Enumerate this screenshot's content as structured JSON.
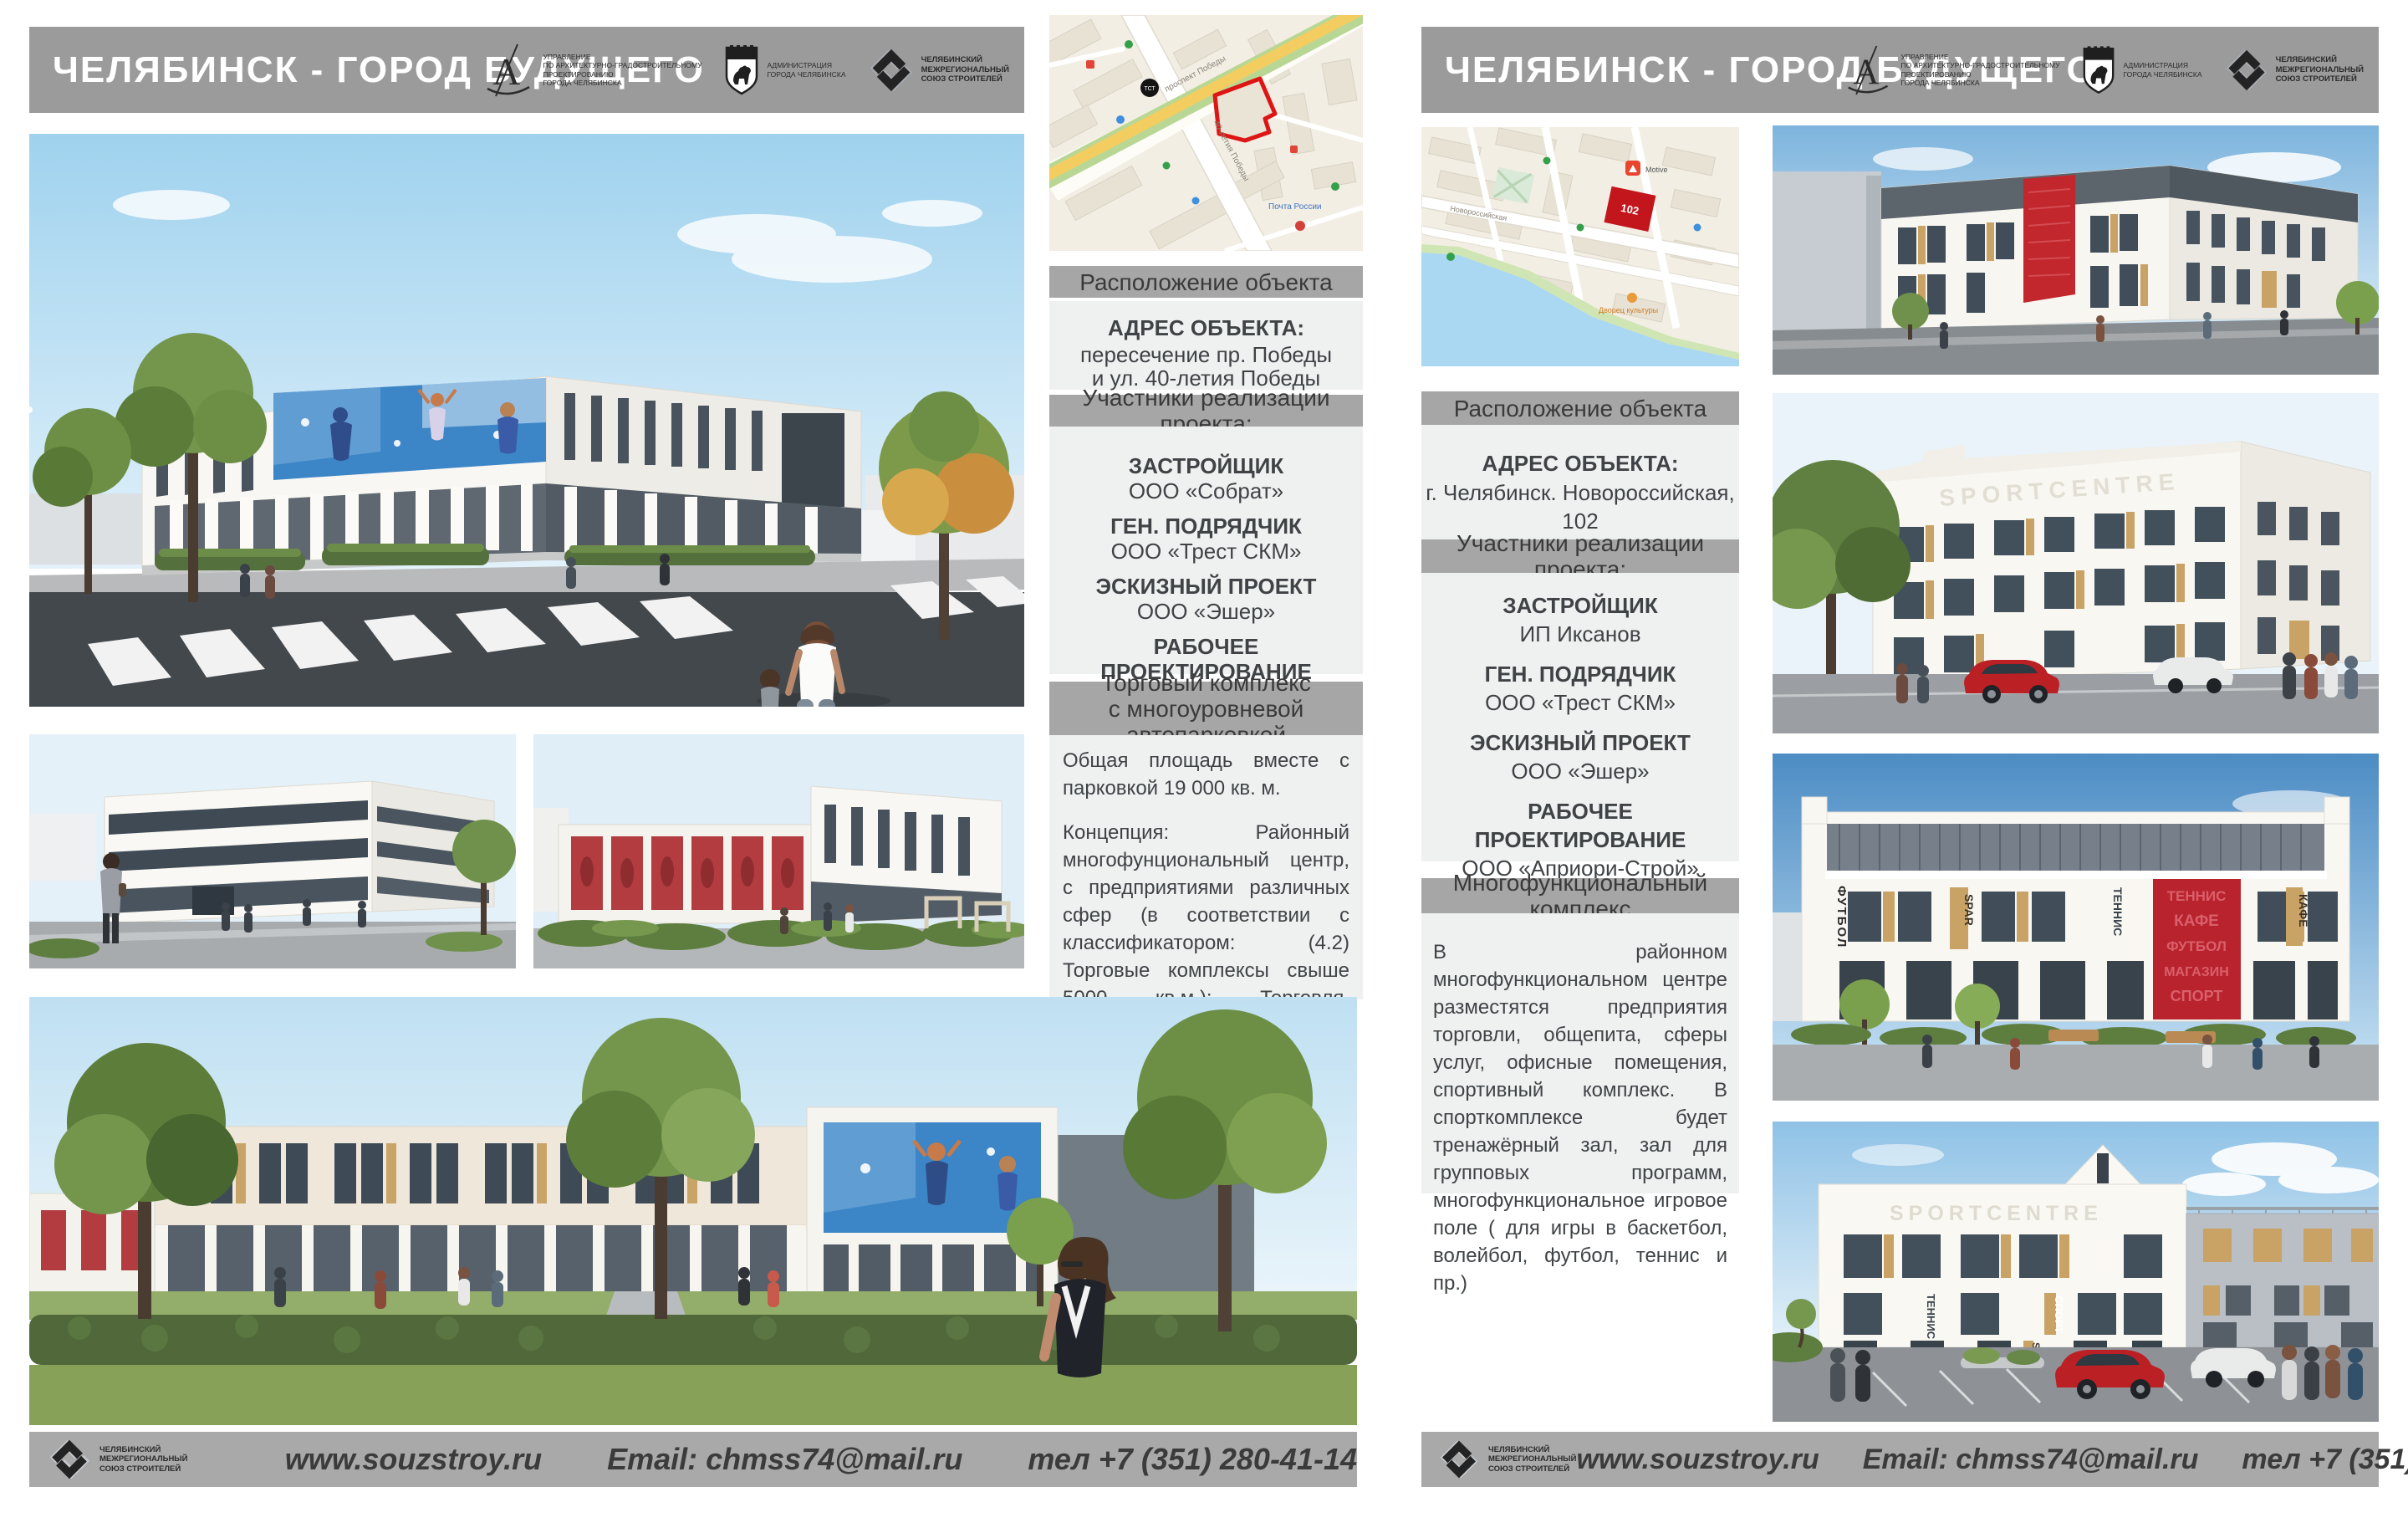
{
  "colors": {
    "header_gray": "#9b9b9b",
    "section_bar_gray": "#a6a6a6",
    "section_block_bg": "#eff1f1",
    "footer_gray": "#a9a9a9",
    "accent_red": "#c1272d",
    "map_site_red": "#dd1514",
    "mural_blue": "#3c85c6",
    "text_dark": "#3f4345",
    "title_white": "#ffffff"
  },
  "logos": {
    "architecture": {
      "lines": [
        "УПРАВЛЕНИЕ",
        "ПО АРХИТЕКТУРНО-ГРАДОСТРОИТЕЛЬНОМУ",
        "ПРОЕКТИРОВАНИЮ",
        "ГОРОДА ЧЕЛЯБИНСКА"
      ]
    },
    "administration": {
      "lines": [
        "АДМИНИСТРАЦИЯ",
        "ГОРОДА ЧЕЛЯБИНСКА"
      ]
    },
    "union": {
      "lines": [
        "ЧЕЛЯБИНСКИЙ",
        "МЕЖРЕГИОНАЛЬНЫЙ",
        "СОЮЗ СТРОИТЕЛЕЙ"
      ]
    }
  },
  "footer": {
    "website": "www.souzstroy.ru",
    "email": "Email: chmss74@mail.ru",
    "phone": "тел +7 (351) 280-41-14"
  },
  "poster_left": {
    "title": "ЧЕЛЯБИНСК - ГОРОД БУДУЩЕГО",
    "location_heading": "Расположение объекта",
    "address_label": "АДРЕС ОБЪЕКТА:",
    "address_lines": [
      "пересечение пр. Победы",
      "и ул. 40-летия Победы"
    ],
    "participants_heading": "Участники реализации проекта:",
    "participants": [
      {
        "role": "ЗАСТРОЙЩИК",
        "name": "ООО «Собрат»"
      },
      {
        "role": "ГЕН.  ПОДРЯДЧИК",
        "name": "ООО «Трест СКМ»"
      },
      {
        "role": "ЭСКИЗНЫЙ ПРОЕКТ",
        "name": "ООО «Эшер»"
      },
      {
        "role": "РАБОЧЕЕ ПРОЕКТИРОВАНИЕ",
        "name": "ООО ПКБ «Профиль-Проект»"
      }
    ],
    "project_heading_lines": [
      "Торговый комплекс",
      "с многоуровневой автопарковкой"
    ],
    "description_paragraphs": [
      "Общая площадь вместе с парковкой 19 000 кв. м.",
      "Концепция: Районный многофунциональный центр, с предприятиями различных сфер (в соответствии с классификатором: (4.2) Торговые комплексы свыше 5000 кв.м.): Торговля, общепит, сфера услуг, банковское обслуживание, развлекательные зоны с 25-ти метровым бассейном, джакузи, сауной, хамамом и пр.)"
    ],
    "map_labels": {
      "transit": "ТСТ",
      "street1": "проспект Победы",
      "street2": "40-летия Победы",
      "poi": "Почта России"
    }
  },
  "poster_right": {
    "title": "ЧЕЛЯБИНСК - ГОРОД БУДУЩЕГО",
    "location_heading": "Расположение объекта",
    "address_label": "АДРЕС ОБЪЕКТА:",
    "address_lines": [
      "г. Челябинск. Новороссийская, 102"
    ],
    "participants_heading": "Участники реализации проекта:",
    "participants": [
      {
        "role": "ЗАСТРОЙЩИК",
        "name": "ИП Иксанов"
      },
      {
        "role": "ГЕН.  ПОДРЯДЧИК",
        "name": "ООО «Трест СКМ»"
      },
      {
        "role": "ЭСКИЗНЫЙ ПРОЕКТ",
        "name": "ООО «Эшер»"
      },
      {
        "role": "РАБОЧЕЕ ПРОЕКТИРОВАНИЕ",
        "name": "ООО «Априори-Строй»"
      }
    ],
    "project_heading_lines": [
      "Многофункциональный комплекс"
    ],
    "description_paragraphs": [
      "В районном многофункциональном центре разместятся предприятия торговли, общепита, сферы услуг, офисные помещения, спортивный комплекс.  В спорткомплексе будет тренажёрный зал, зал для групповых программ, многофункциональное игровое поле ( для игры в баскетбол, волейбол, футбол, теннис и пр.)"
    ],
    "map_labels": {
      "site_number": "102",
      "street": "Новороссийская",
      "poi1": "Motive",
      "poi2": "Дворец культуры"
    },
    "render_labels": {
      "sportcentre": "SPORTCENTRE",
      "football": "ФУТБОЛ",
      "tennis": "ТЕННИС",
      "spar": "SPAR",
      "cafe": "КАФЕ",
      "sport": "СПОРТ",
      "red_panel_words": [
        "ТЕННИС",
        "КАФЕ",
        "ФУТБОЛ",
        "МАГАЗИН",
        "СПОРТ"
      ]
    }
  }
}
